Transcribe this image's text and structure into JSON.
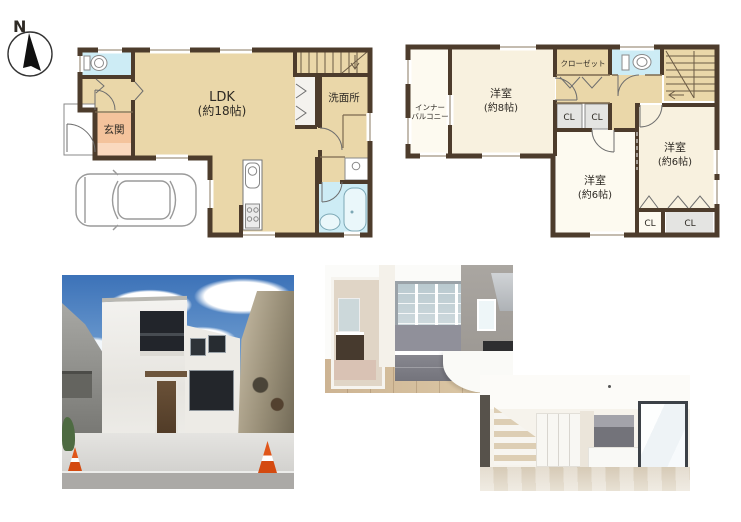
{
  "compass": {
    "north_label": "N"
  },
  "floorplan_colors": {
    "wall": "#4d3c2c",
    "room_tan": "#ead7a9",
    "room_cream": "#f8f1df",
    "room_white": "#fdfaf0",
    "water_blue": "#cdecf5",
    "entry_salmon": "#f4c39c",
    "entry_salmon_light": "#fad9bf",
    "closet_gray": "#e4e4e2",
    "cone_orange": "#e0561a"
  },
  "floor1": {
    "ldk_label_line1": "LDK",
    "ldk_label_line2": "(約18帖)",
    "entrance_label": "玄関",
    "washroom_label": "洗面所"
  },
  "floor2": {
    "inner_balcony_line1": "インナー",
    "inner_balcony_line2": "バルコニー",
    "closet_label": "クローゼット",
    "bedroom8_line1": "洋室",
    "bedroom8_line2": "(約8帖)",
    "cl_upper_left": "CL",
    "cl_upper_right": "CL",
    "bedroom6_center_line1": "洋室",
    "bedroom6_center_line2": "(約6帖)",
    "bedroom6_right_line1": "洋室",
    "bedroom6_right_line2": "(約6帖)",
    "cl_lower_left": "CL",
    "cl_lower_right": "CL"
  }
}
